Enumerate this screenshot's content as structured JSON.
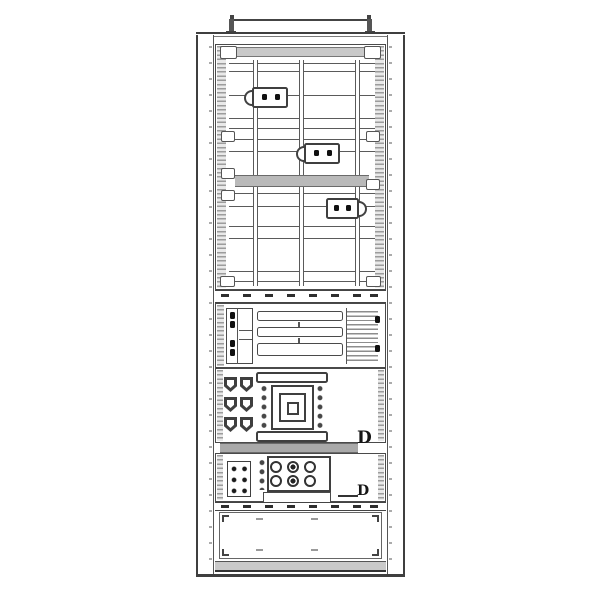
{
  "drawing": {
    "type": "technical-line-drawing",
    "subject": "electrical-cabinet-front-elevation",
    "labels": {
      "upper_feeder": "D",
      "lower_feeder": "D"
    },
    "colors": {
      "line": "#4a4a4a",
      "line_strong": "#1a1a1a",
      "shade_light": "#c9c9c9",
      "shade_mid": "#b9b9b9",
      "hatch": "#9c9c9c",
      "background": "#ffffff"
    },
    "components": [
      "lifting-bar",
      "top-plate",
      "left-frame-column",
      "right-frame-column",
      "busbar-compartment",
      "vertical-busbar",
      "branch-device",
      "terminal-strip",
      "drawer-unit",
      "terminal-block",
      "drawer-slot",
      "louver-panel",
      "breaker-compartment",
      "cable-lug",
      "air-circuit-breaker",
      "busbar-band",
      "contactor-compartment",
      "contactor",
      "aux-terminal-block",
      "bottom-rail",
      "bottom-cover-panel",
      "plinth"
    ]
  }
}
